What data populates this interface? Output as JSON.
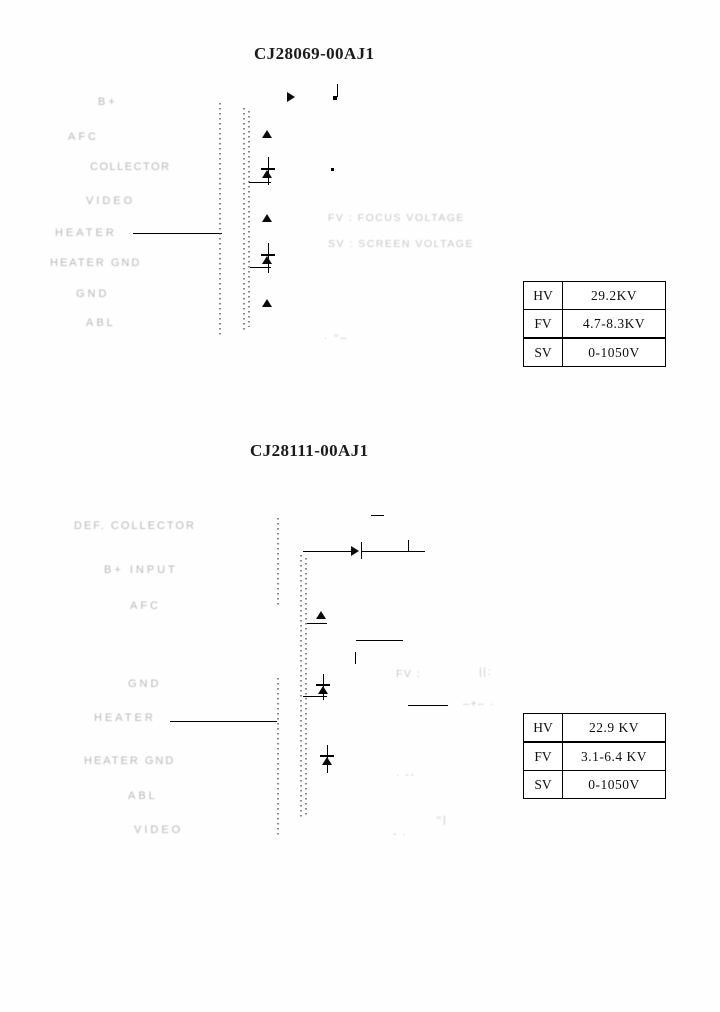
{
  "s1": {
    "title": "CJ28069-00AJ1",
    "pins": [
      "B+",
      "AFC",
      "COLLECTOR",
      "VIDEO",
      "HEATER",
      "HEATER GND",
      "GND",
      "ABL"
    ],
    "notes": [
      "FV : FOCUS VOLTAGE",
      "SV : SCREEN VOLTAGE"
    ],
    "corner_marks": "· ⁼–",
    "table": {
      "rows": [
        {
          "label": "HV",
          "value": "29.2KV"
        },
        {
          "label": "FV",
          "value": "4.7-8.3KV"
        },
        {
          "label": "SV",
          "value": "0-1050V"
        }
      ]
    }
  },
  "s2": {
    "title": "CJ28111-00AJ1",
    "pins": [
      "DEF. COLLECTOR",
      "B+ INPUT",
      "AFC",
      "GND",
      "HEATER",
      "HEATER GND",
      "ABL",
      "VIDEO"
    ],
    "note_focus": "FV :",
    "note_focus_frag": "||:",
    "note_cross": "–+– ·",
    "marks": {
      "m1": "· ‐‐",
      "m2": "⁼|",
      "m3": "‐ ·"
    },
    "table": {
      "rows": [
        {
          "label": "HV",
          "value": "22.9 KV"
        },
        {
          "label": "FV",
          "value": "3.1-6.4 KV"
        },
        {
          "label": "SV",
          "value": "0-1050V"
        }
      ]
    }
  }
}
